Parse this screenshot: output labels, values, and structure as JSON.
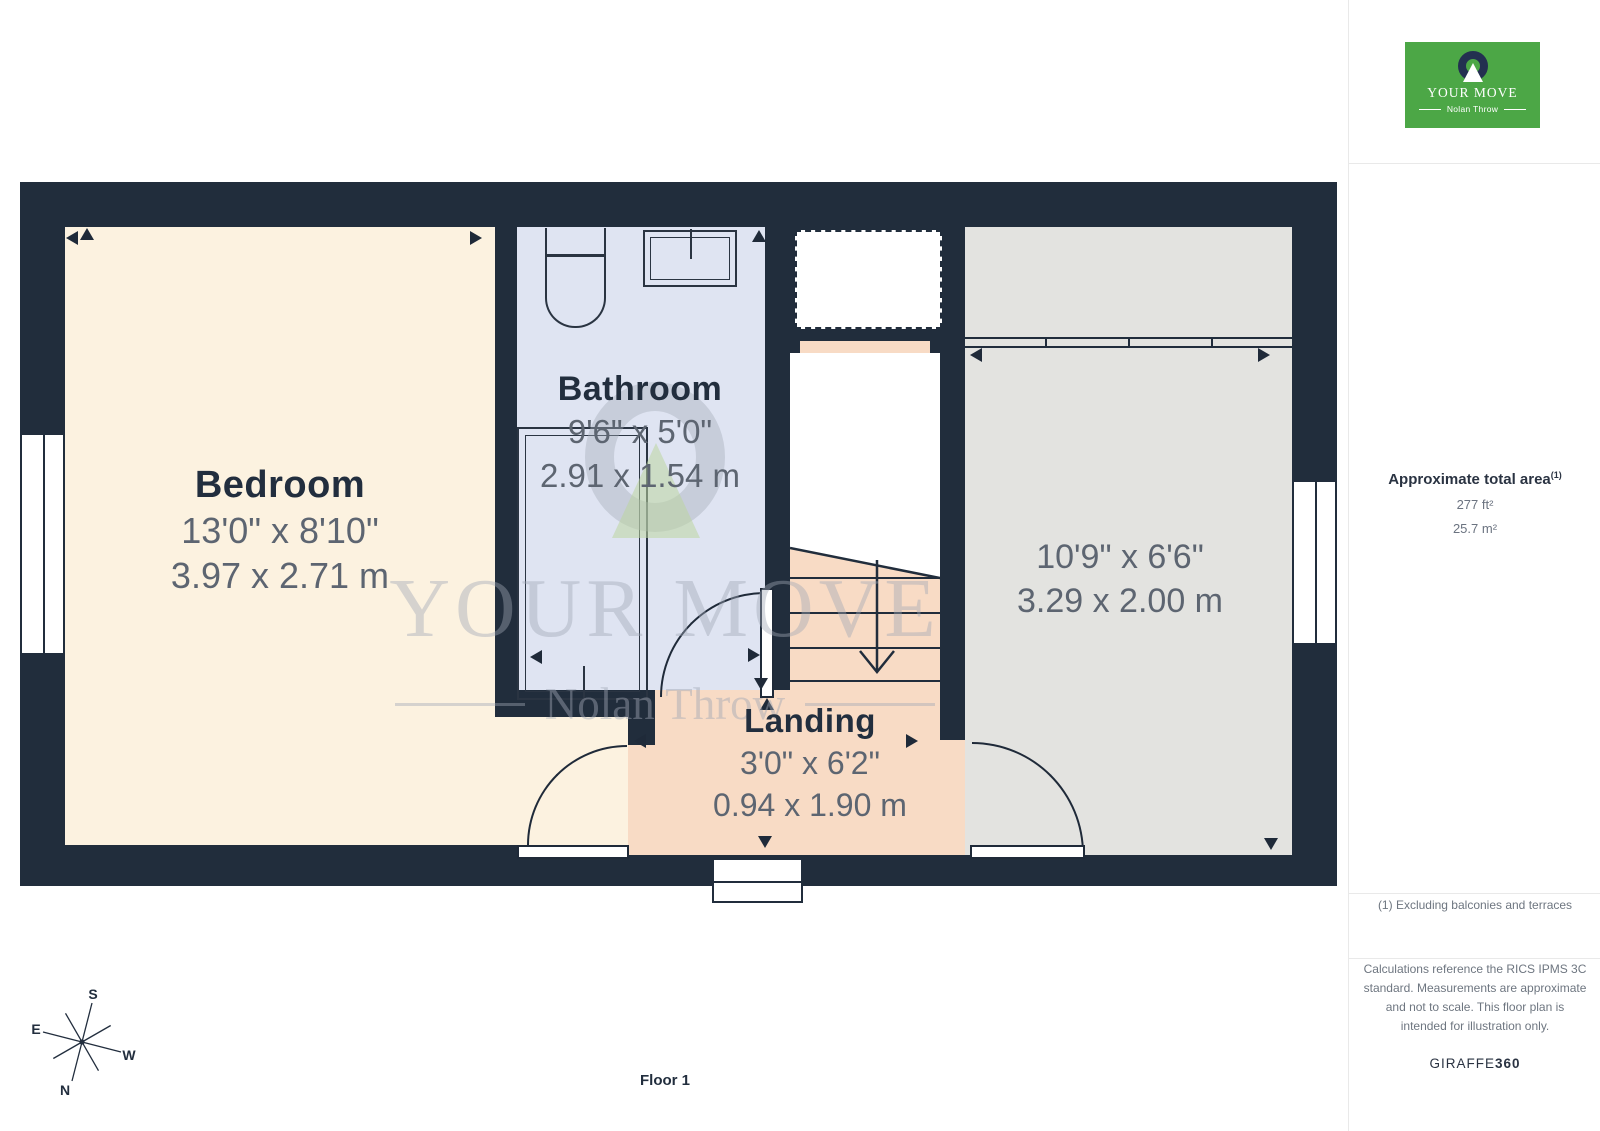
{
  "branding": {
    "logo": {
      "name": "YOUR MOVE",
      "subtitle": "Nolan Throw"
    },
    "watermark": {
      "line1": "YOUR MOVE",
      "line2": "Nolan Throw"
    }
  },
  "floor": {
    "label": "Floor 1"
  },
  "rooms": [
    {
      "id": "bedroom",
      "name": "Bedroom",
      "dims_imperial": "13'0\" x 8'10\"",
      "dims_metric": "3.97 x 2.71 m"
    },
    {
      "id": "bathroom",
      "name": "Bathroom",
      "dims_imperial": "9'6\" x 5'0\"",
      "dims_metric": "2.91 x 1.54 m"
    },
    {
      "id": "landing",
      "name": "Landing",
      "dims_imperial": "3'0\" x 6'2\"",
      "dims_metric": "0.94 x 1.90 m"
    },
    {
      "id": "room",
      "name": "",
      "dims_imperial": "10'9\" x 6'6\"",
      "dims_metric": "3.29 x 2.00 m"
    }
  ],
  "sidebar": {
    "area_title": "Approximate total area",
    "area_superscript": "(1)",
    "area_ft": "277 ft²",
    "area_m": "25.7 m²",
    "footnote": "(1) Excluding balconies and terraces",
    "disclaimer": "Calculations reference the RICS IPMS 3C standard. Measurements are approximate and not to scale. This floor plan is intended for illustration only.",
    "provider": "GIRAFFE",
    "provider_bold": "360"
  },
  "compass": {
    "n": "N",
    "s": "S",
    "e": "E",
    "w": "W"
  },
  "colors": {
    "wall": "#212d3c",
    "bedroom": "#fcf2e0",
    "bathroom": "#dfe4f2",
    "landing": "#f8dbc5",
    "room_gray": "#e3e3e0",
    "label_navy": "#222e3e",
    "dims_gray": "#5d6571",
    "logo_green": "#4ca746",
    "logo_navy": "#233050"
  }
}
